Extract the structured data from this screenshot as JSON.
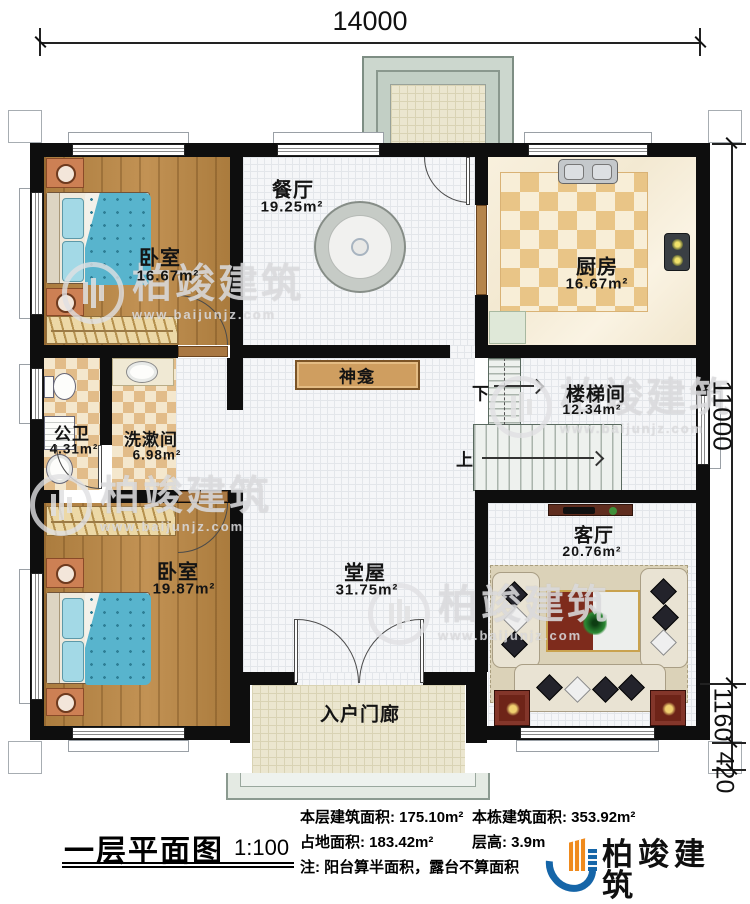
{
  "plan": {
    "dim_top": "14000",
    "dim_right_main": "11000",
    "dim_right_mid": "1160",
    "dim_right_bottom": "420",
    "stair_up": "上",
    "stair_down": "下"
  },
  "rooms": {
    "bedroom_top": {
      "name": "卧室",
      "area": "16.67m²"
    },
    "dining": {
      "name": "餐厅",
      "area": "19.25m²"
    },
    "kitchen": {
      "name": "厨房",
      "area": "16.67m²"
    },
    "shrine": {
      "name": "神龛"
    },
    "stairwell": {
      "name": "楼梯间",
      "area": "12.34m²"
    },
    "bathroom": {
      "name": "公卫",
      "area": "4.31m²"
    },
    "washroom": {
      "name": "洗漱间",
      "area": "6.98m²"
    },
    "bedroom_bottom": {
      "name": "卧室",
      "area": "19.87m²"
    },
    "hall": {
      "name": "堂屋",
      "area": "31.75m²"
    },
    "living": {
      "name": "客厅",
      "area": "20.76m²"
    },
    "entry_porch": {
      "name": "入户门廊"
    }
  },
  "title_block": {
    "title": "一层平面图",
    "scale": "1:100",
    "floor_area_label": "本层建筑面积: ",
    "floor_area_value": "175.10m²",
    "total_area_label": "本栋建筑面积: ",
    "total_area_value": "353.92m²",
    "footprint_label": "占地面积: ",
    "footprint_value": "183.42m²",
    "storey_height_label": "层高: ",
    "storey_height_value": "3.9m",
    "note": "注: 阳台算半面积，露台不算面积"
  },
  "brand": {
    "name": "柏竣建筑",
    "website": "www.baijunjz.com"
  },
  "watermark": {
    "name": "柏竣建筑",
    "website": "www.baijunjz.com"
  },
  "colors": {
    "wall": "#0e0e0e",
    "wood_floor": "#b5874a",
    "bed_quilt": "#58b4cd",
    "kitchen_tile": "#e9c587",
    "brand_blue": "#1565a8",
    "brand_orange": "#ef8a1d"
  }
}
